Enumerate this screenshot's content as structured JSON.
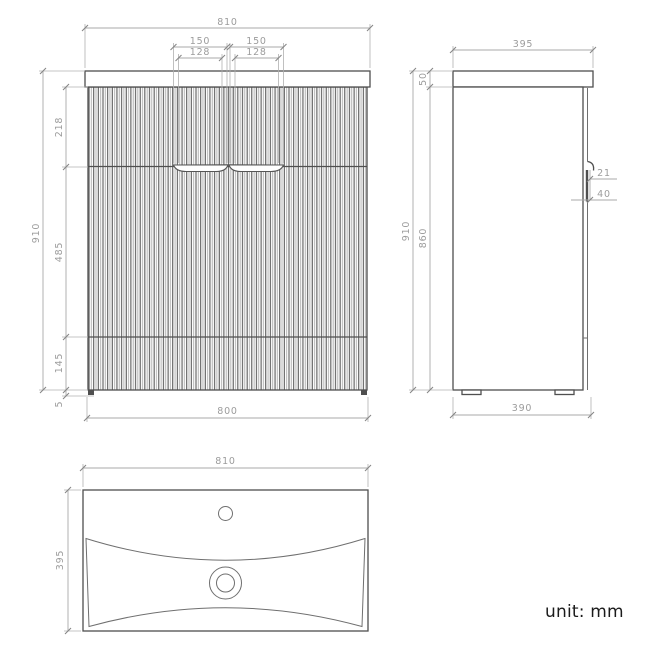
{
  "note": {
    "unit": "unit: mm"
  },
  "front": {
    "width_top": "810",
    "handle_left_outer": "150",
    "handle_right_outer": "150",
    "handle_left_inner": "128",
    "handle_right_inner": "128",
    "drawer_top_height": "218",
    "overall_height": "910",
    "middle_height": "485",
    "bottom_height": "145",
    "foot_height": "5",
    "width_bottom": "800"
  },
  "side": {
    "depth_top": "395",
    "counter_thickness": "50",
    "overall_height": "910",
    "cabinet_height": "860",
    "handle_lip": "21",
    "handle_recess": "40",
    "depth_bottom": "390"
  },
  "top": {
    "width": "810",
    "depth": "395"
  },
  "colors": {
    "outline": "#4f4f4f",
    "dimension_line": "#a8a8a8",
    "dimension_text": "#9c9c9c",
    "flute_dark": "#4a4a4a",
    "flute_light": "#ababab",
    "note_text": "#1b1b1b"
  }
}
